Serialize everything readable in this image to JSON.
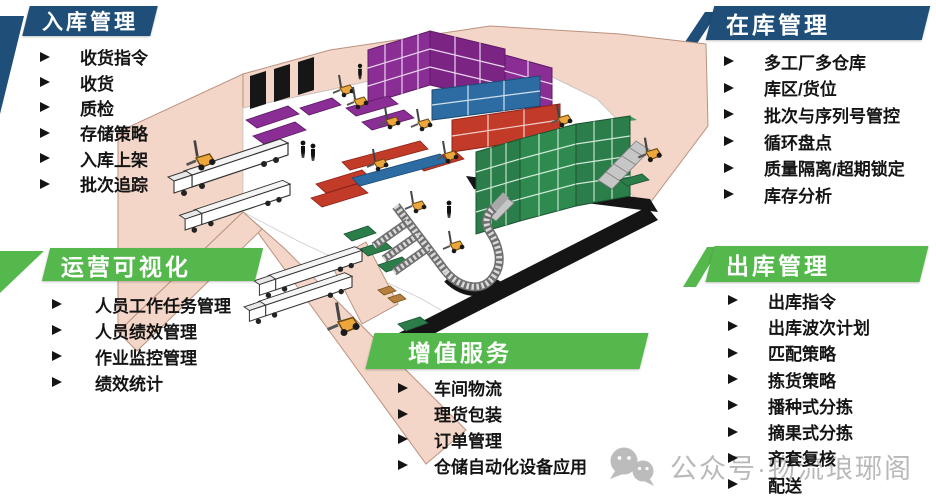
{
  "panels": [
    {
      "id": "inbound",
      "title": "入库管理",
      "header_color": "#1f4e79",
      "items": [
        "收货指令",
        "收货",
        "质检",
        "存储策略",
        "入库上架",
        "批次追踪"
      ]
    },
    {
      "id": "in-stock",
      "title": "在库管理",
      "header_color": "#1f4e79",
      "items": [
        "多工厂多仓库",
        "库区/货位",
        "批次与序列号管控",
        "循环盘点",
        "质量隔离/超期锁定",
        "库存分析"
      ]
    },
    {
      "id": "operations-visibility",
      "title": "运营可视化",
      "header_color": "#55b84c",
      "items": [
        "人员工作任务管理",
        "人员绩效管理",
        "作业监控管理",
        "绩效统计"
      ]
    },
    {
      "id": "value-added-services",
      "title": "增值服务",
      "header_color": "#55b84c",
      "items": [
        "车间物流",
        "理货包装",
        "订单管理",
        "仓储自动化设备应用"
      ]
    },
    {
      "id": "outbound",
      "title": "出库管理",
      "header_color": "#55b84c",
      "items": [
        "出库指令",
        "出库波次计划",
        "匹配策略",
        "拣货策略",
        "播种式分拣",
        "摘果式分拣",
        "齐套复核",
        "配送"
      ]
    }
  ],
  "watermark": {
    "text": "公众号·物流琅琊阁",
    "icon": "wechat-icon",
    "color": "#b9b9b9"
  },
  "illustration": {
    "name": "isometric-warehouse-cutaway",
    "colors": {
      "walls_pink": "#f3d6c7",
      "floor_white": "#ffffff",
      "rack_purple": "#8a2d94",
      "rack_blue": "#2d6ca2",
      "rack_red": "#c23a28",
      "rack_green": "#2b7d49",
      "forklift_yellow": "#eda63b",
      "shadow_black": "#151515",
      "conveyor_gray": "#8f8f8f",
      "truck_white": "#ffffff",
      "header_blue": "#1f4e79",
      "header_green": "#55b84c"
    }
  }
}
